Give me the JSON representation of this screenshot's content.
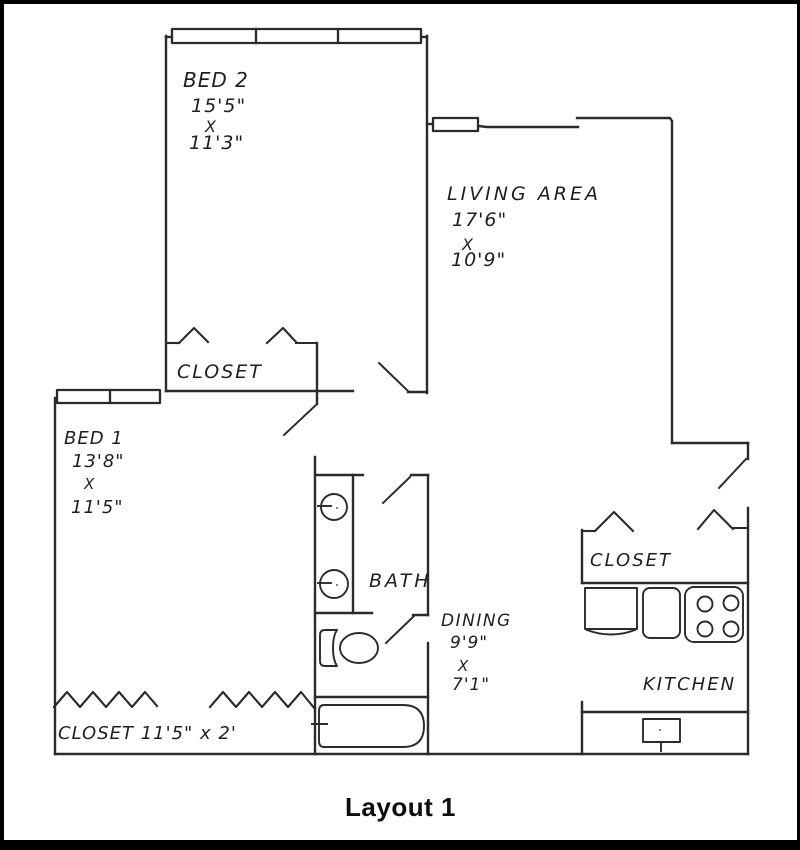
{
  "caption": "Layout 1",
  "colors": {
    "ink": "#2b2b2b",
    "frame": "#000000",
    "background": "#ffffff"
  },
  "rooms": {
    "bed2": {
      "name": "BED 2",
      "dim_w": "15'5\"",
      "dim_sep": "X",
      "dim_h": "11'3\""
    },
    "living": {
      "name": "LIVING AREA",
      "dim_w": "17'6\"",
      "dim_sep": "X",
      "dim_h": "10'9\""
    },
    "bed1": {
      "name": "BED 1",
      "dim_w": "13'8\"",
      "dim_sep": "X",
      "dim_h": "11'5\""
    },
    "dining": {
      "name": "DINING",
      "dim_w": "9'9\"",
      "dim_sep": "X",
      "dim_h": "7'1\""
    },
    "bath": {
      "name": "BATH"
    },
    "kitchen": {
      "name": "KITCHEN"
    },
    "hall_closet": {
      "name": "CLOSET"
    },
    "kitchen_closet": {
      "name": "CLOSET"
    },
    "bed1_closet": {
      "name": "CLOSET 11'5\" x 2'"
    }
  }
}
